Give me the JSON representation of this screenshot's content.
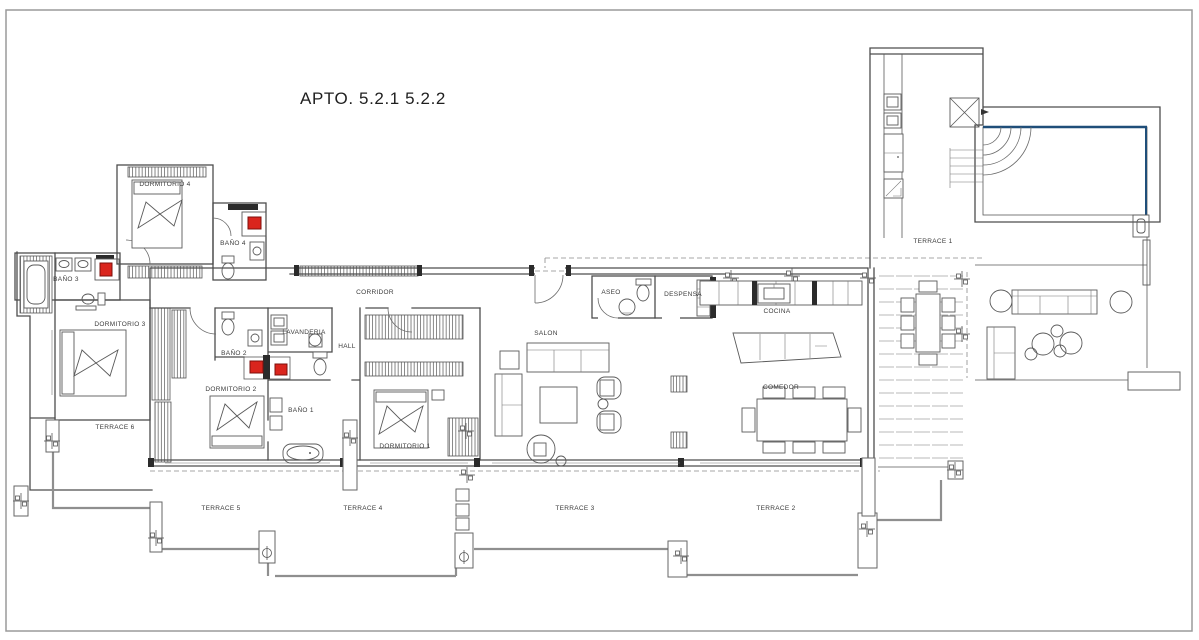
{
  "title": "APTO. 5.2.1  5.2.2",
  "rooms": {
    "dormitorio_1": "DORMITORIO 1",
    "dormitorio_2": "DORMITORIO 2",
    "dormitorio_3": "DORMITORIO 3",
    "dormitorio_4": "DORMITORIO 4",
    "bano_1": "BAÑO 1",
    "bano_2": "BAÑO 2",
    "bano_3": "BAÑO 3",
    "bano_4": "BAÑO 4",
    "corridor": "CORRIDOR",
    "hall": "HALL",
    "lavanderia": "LAVANDERIA",
    "salon": "SALON",
    "aseo": "ASEO",
    "despensa": "DESPENSA",
    "cocina": "COCINA",
    "comedor": "COMEDOR"
  },
  "terraces": {
    "terrace_1": "TERRACE 1",
    "terrace_2": "TERRACE 2",
    "terrace_3": "TERRACE 3",
    "terrace_4": "TERRACE 4",
    "terrace_5": "TERRACE 5",
    "terrace_6": "TERRACE 6"
  },
  "colors": {
    "marker_red": "#da251d",
    "marker_red_border": "#7d0f0b",
    "pool_blue": "#1f4e79",
    "wall_gray": "#4d4d4d"
  }
}
